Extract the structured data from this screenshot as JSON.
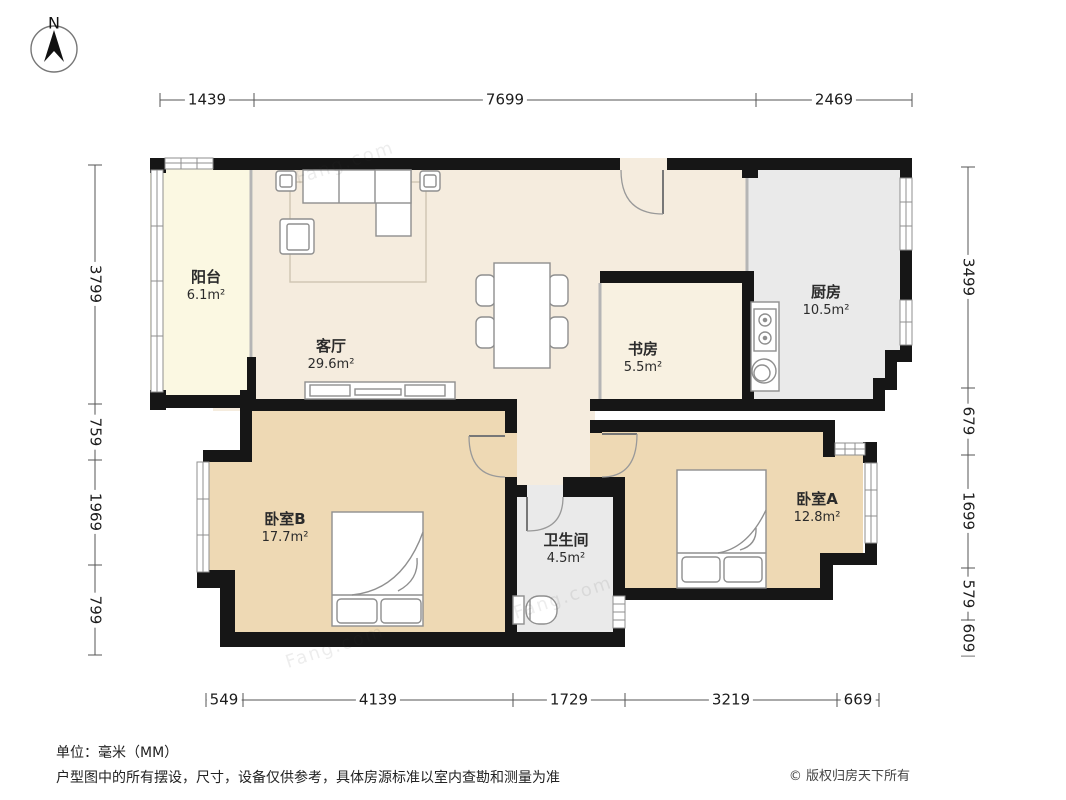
{
  "compass": {
    "label": "N"
  },
  "floor_plan": {
    "rooms": [
      {
        "id": "balcony",
        "name": "阳台",
        "area": "6.1m²"
      },
      {
        "id": "living",
        "name": "客厅",
        "area": "29.6m²"
      },
      {
        "id": "study",
        "name": "书房",
        "area": "5.5m²"
      },
      {
        "id": "kitchen",
        "name": "厨房",
        "area": "10.5m²"
      },
      {
        "id": "bedroomB",
        "name": "卧室B",
        "area": "17.7m²"
      },
      {
        "id": "bathroom",
        "name": "卫生间",
        "area": "4.5m²"
      },
      {
        "id": "bedroomA",
        "name": "卧室A",
        "area": "12.8m²"
      }
    ],
    "colors": {
      "wall": "#161616",
      "living_floor": "#f5ecde",
      "bedroom_floor": "#eed9b4",
      "balcony_floor": "#fbf8e2",
      "wet_floor": "#eaeaea",
      "study_floor": "#f8f1e1"
    }
  },
  "dimensions": {
    "top": [
      "1439",
      "7699",
      "2469"
    ],
    "left": [
      "3799",
      "759",
      "1969",
      "799"
    ],
    "right": [
      "3499",
      "679",
      "1699",
      "579",
      "609"
    ],
    "bottom": [
      "549",
      "4139",
      "1729",
      "3219",
      "669"
    ]
  },
  "watermark": "Fang.com",
  "footer": {
    "unit": "单位：毫米（MM）",
    "disclaimer": "户型图中的所有摆设，尺寸，设备仅供参考，具体房源标准以室内查勘和测量为准",
    "copyright": "© 版权归房天下所有"
  }
}
